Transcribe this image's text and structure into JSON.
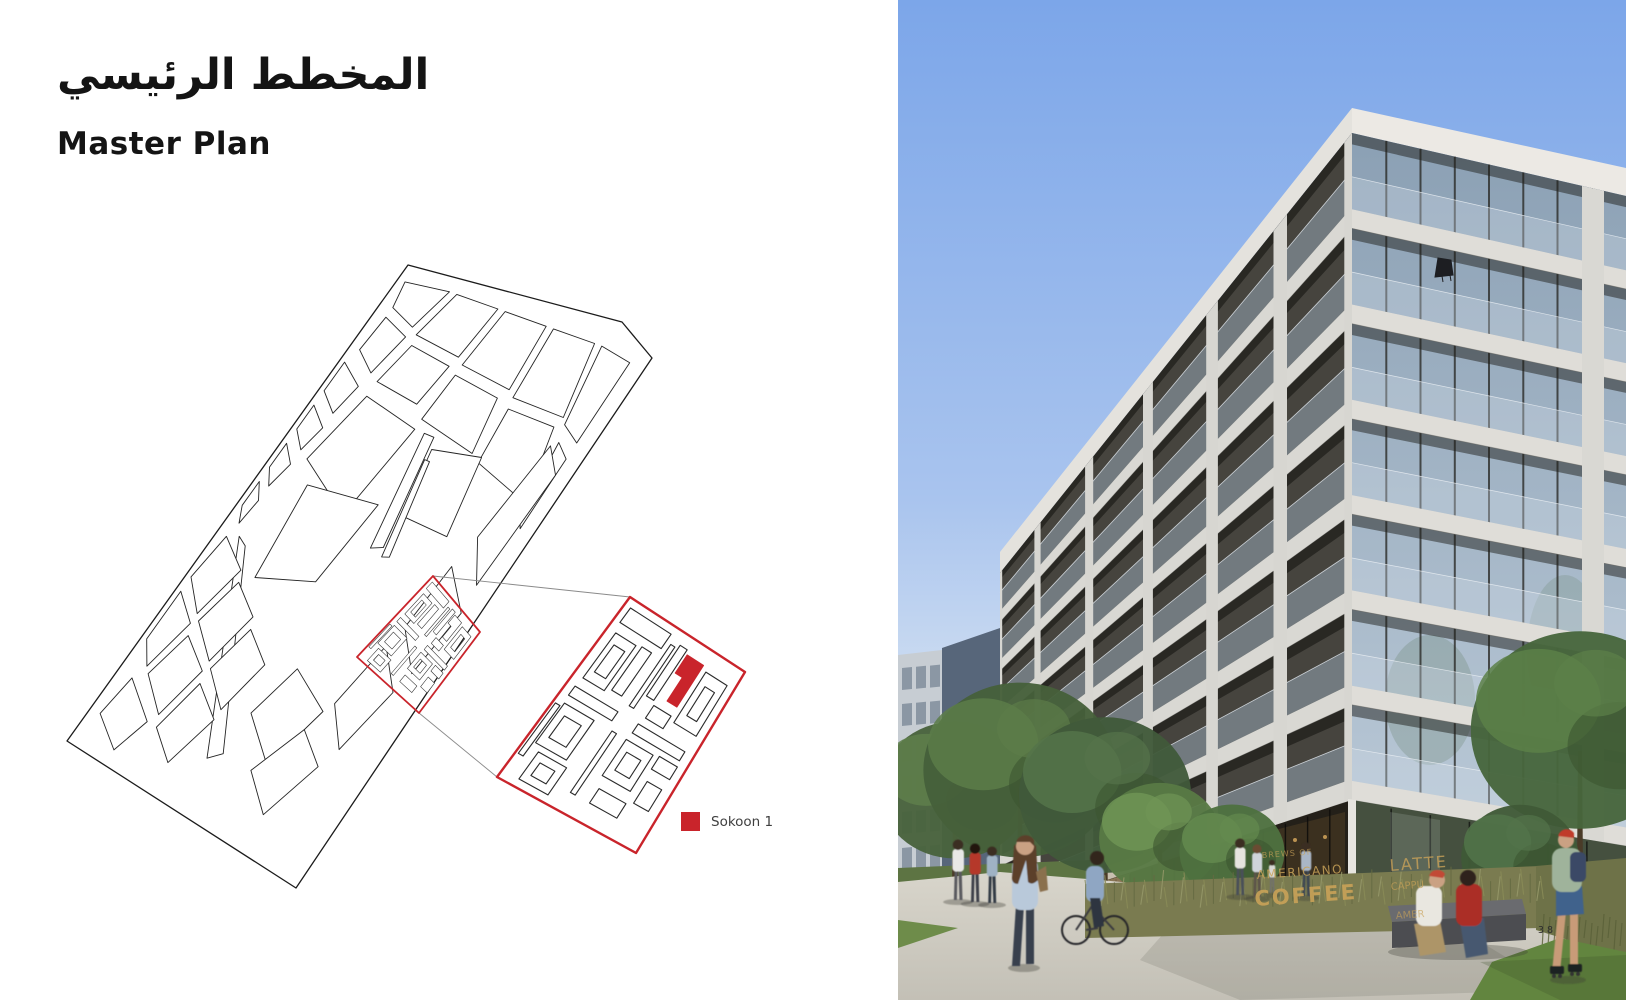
{
  "theme": {
    "accent": "#C9242B",
    "text_primary": "#141414",
    "legend_text": "#3f3f3f"
  },
  "header": {
    "title_ar": "المخطط الرئيسي",
    "title_en": "Master Plan"
  },
  "legend": {
    "items": [
      {
        "label": "Sokoon 1",
        "color": "#C9242B"
      }
    ]
  },
  "photo": {
    "storefront_sign": {
      "line1": "BREWS OF",
      "line2": "AMERICANO",
      "line3": "COFFEE",
      "line4": "LATTE",
      "line5": "CAPPU",
      "line6": "AMER"
    }
  },
  "footer": {
    "page_number": "38"
  }
}
